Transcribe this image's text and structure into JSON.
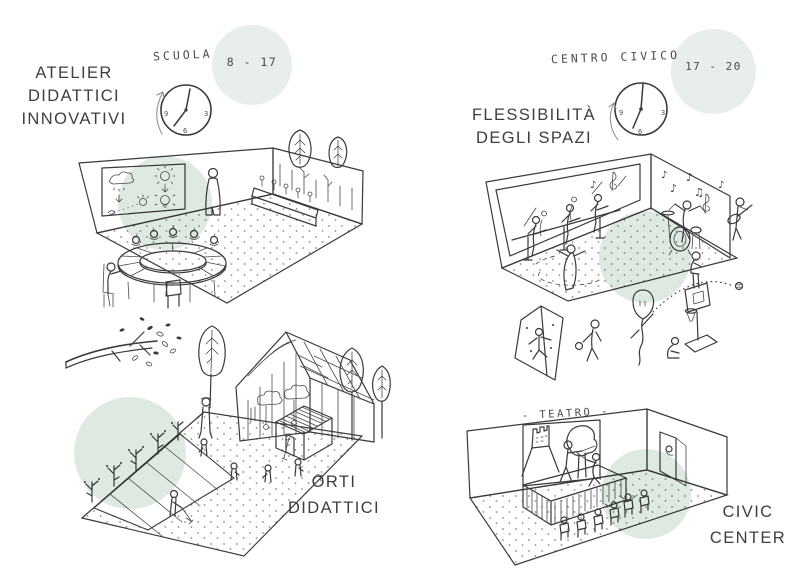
{
  "colors": {
    "background": "#ffffff",
    "ink": "#3a3a3a",
    "scene_highlight": "#dbe7de",
    "hours_highlight": "#e8eee9"
  },
  "school": {
    "title_lines": [
      "ATELIER",
      "DIDATTICI",
      "INNOVATIVI"
    ],
    "schedule_label": "SCUOLA",
    "schedule_hours": "8 - 17",
    "clock_numbers": [
      "9",
      "3",
      "6"
    ]
  },
  "civic": {
    "schedule_label": "CENTRO CIVICO",
    "schedule_hours": "17 - 20",
    "clock_numbers": [
      "9",
      "3",
      "6"
    ],
    "flexibility_title_lines": [
      "FLESSIBILITÀ",
      "DEGLI SPAZI"
    ]
  },
  "garden": {
    "title_lines": [
      "ORTI",
      "DIDATTICI"
    ]
  },
  "theater": {
    "stage_sign": "- TEATRO -",
    "title_lines": [
      "CIVIC",
      "CENTER"
    ]
  },
  "music_room": {
    "mirror_notes": [
      "♪"
    ],
    "wall_notes": [
      "♪",
      "♪",
      "♪",
      "♫",
      "♪"
    ]
  }
}
